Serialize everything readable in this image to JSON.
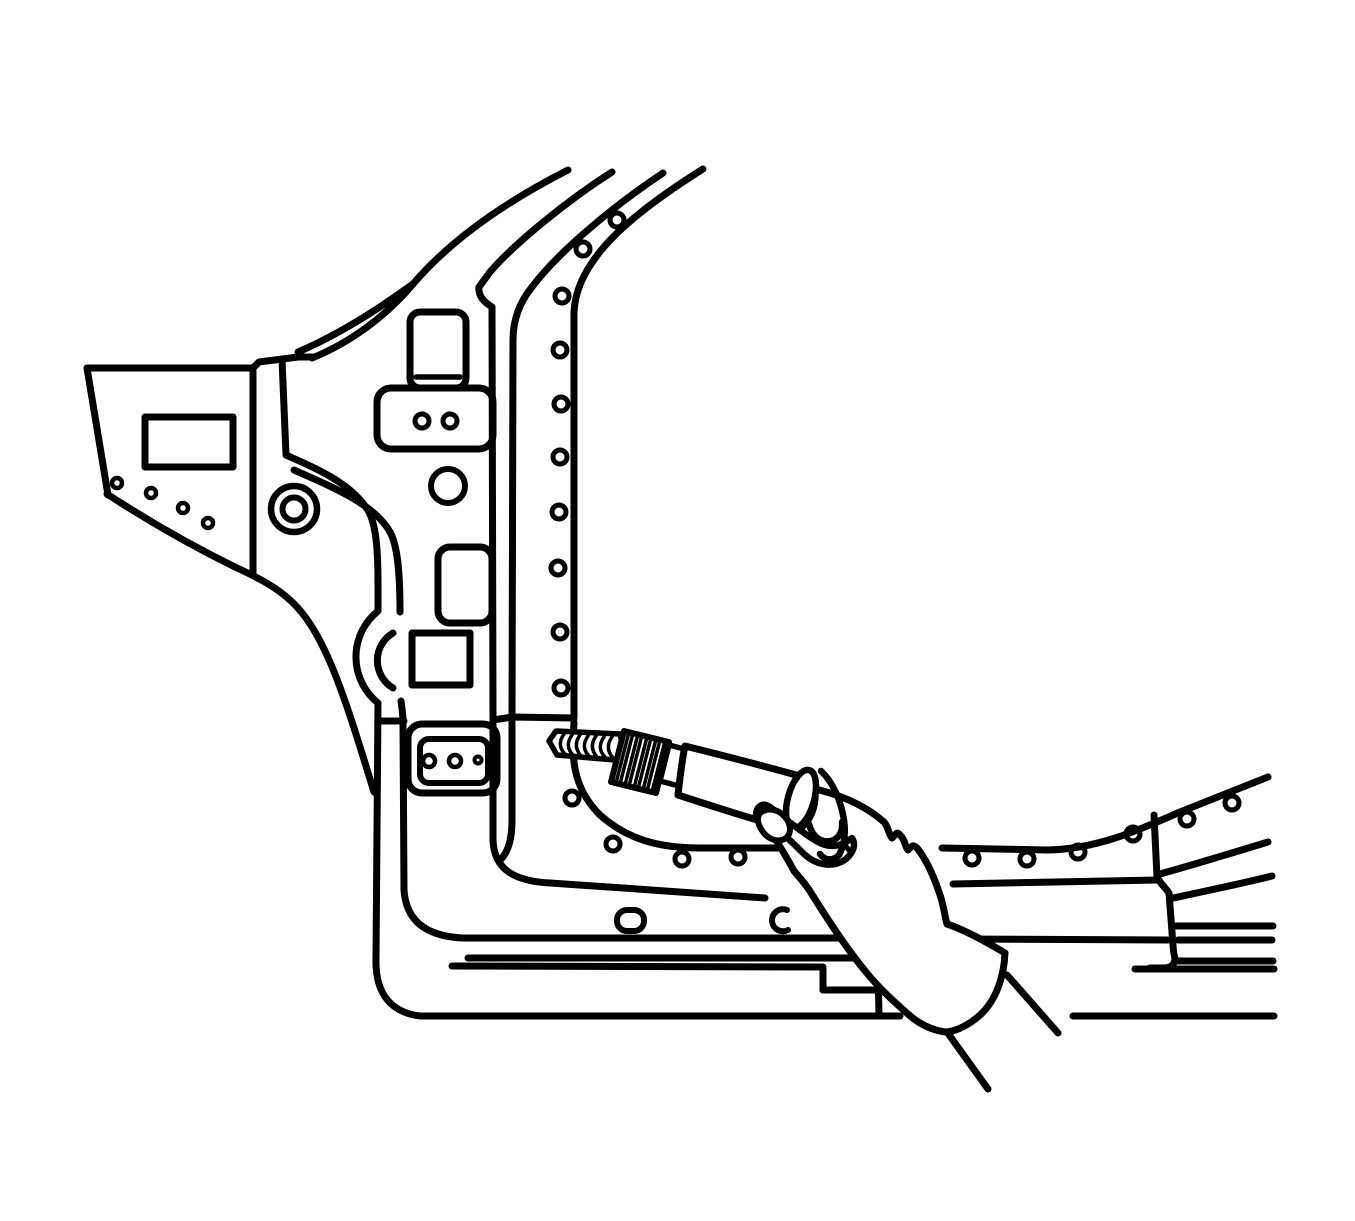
{
  "figure": {
    "kind": "technical-line-illustration",
    "subject": "drilling-spot-welds-on-body-hinge-pillar",
    "canvas": {
      "width": 1355,
      "height": 1221,
      "background": "#ffffff"
    },
    "style": {
      "stroke": "#000000",
      "stroke_width": 7,
      "fill": "none",
      "occlusion_fill": "#ffffff"
    },
    "shapes": [
      {
        "name": "fender-left-edge",
        "type": "path",
        "d": "M 87 368 L 108 495"
      },
      {
        "name": "fender-top-edge",
        "type": "path",
        "d": "M 87 368 L 253 368"
      },
      {
        "name": "cowl-top-jog",
        "type": "path",
        "d": "M 253 368 L 259 362 L 298 357 L 312 357"
      },
      {
        "name": "fender-apillar-ridge-upper",
        "type": "path",
        "d": "M 298 352 C 340 334 380 308 413 284"
      },
      {
        "name": "apillar-line-1",
        "type": "path",
        "d": "M 312 358 C 352 342 388 314 413 284 C 455 235 515 197 568 170"
      },
      {
        "name": "fender-opening-rect",
        "type": "rect",
        "x": 145,
        "y": 417,
        "wd": 88,
        "ht": 50
      },
      {
        "name": "fender-flange-hole-1",
        "type": "circle",
        "cx": 117,
        "cy": 483,
        "r": 5,
        "w": 4.5
      },
      {
        "name": "fender-flange-hole-2",
        "type": "circle",
        "cx": 151,
        "cy": 493,
        "r": 5,
        "w": 4.5
      },
      {
        "name": "fender-flange-hole-3",
        "type": "circle",
        "cx": 183,
        "cy": 508,
        "r": 5,
        "w": 4.5
      },
      {
        "name": "fender-flange-hole-4",
        "type": "circle",
        "cx": 208,
        "cy": 523,
        "r": 5,
        "w": 4.5
      },
      {
        "name": "fender-bottom-edge",
        "type": "path",
        "d": "M 107 494 C 150 522 190 545 235 567 C 285 590 305 605 330 662 C 345 697 358 740 374 792"
      },
      {
        "name": "door-gap-line",
        "type": "path",
        "d": "M 253 370 L 253 573"
      },
      {
        "name": "pillar-outer-contour",
        "type": "path",
        "d": "M 282 359 L 286 455 C 315 468 352 483 369 512 C 377 528 378 556 378 585 L 378 611 A 59 59 0 0 0 378 703 L 376 958 C 375 990 388 1012 420 1016 L 900 1016"
      },
      {
        "name": "rocker-bottom-line-right",
        "type": "path",
        "d": "M 1073 1016 L 1274 1016"
      },
      {
        "name": "pillar-inner-contour-upper",
        "type": "path",
        "d": "M 294 470 C 335 488 375 505 390 532 C 398 546 400 576 400 612"
      },
      {
        "name": "pillar-bulge-inner-arc",
        "type": "path",
        "d": "M 393 633 A 32 32 0 0 0 393 688"
      },
      {
        "name": "pillar-inner-contour-lower",
        "type": "path",
        "d": "M 401 701 C 402 708 403 715 403 722 L 404 890 C 406 920 425 936 462 938 L 843 938"
      },
      {
        "name": "rocker-mid-line-right",
        "type": "path",
        "d": "M 955 939 L 1168 940"
      },
      {
        "name": "apillar-line-2",
        "type": "path",
        "d": "M 612 172 C 568 200 515 243 490 272 L 479 287 C 478 296 484 302 492 307 L 493 718"
      },
      {
        "name": "door-front-edge-lower",
        "type": "path",
        "d": "M 493 722 L 493 840 C 494 868 512 881 550 883 C 620 888 700 893 765 898"
      },
      {
        "name": "door-bottom-line-right",
        "type": "path",
        "d": "M 953 884 L 1157 880"
      },
      {
        "name": "apillar-line-3",
        "type": "path",
        "d": "M 663 173 C 615 205 560 250 532 287 C 519 303 513 320 513 340 L 512 718"
      },
      {
        "name": "apillar-line-3-lower",
        "type": "path",
        "d": "M 512 722 L 512 820 C 512 845 505 856 499 861"
      },
      {
        "name": "apillar-line-4",
        "type": "path",
        "d": "M 703 169 C 660 196 625 222 603 248 C 583 272 575 292 574 312 L 574 718"
      },
      {
        "name": "corner-flange-arc",
        "type": "path",
        "d": "M 574 722 L 573 740 C 572 772 580 795 600 815 C 628 840 660 848 700 848 L 900 848"
      },
      {
        "name": "rocker-flange-top",
        "type": "path",
        "d": "M 942 848 L 1048 850 C 1095 849 1135 832 1180 812 L 1268 777"
      },
      {
        "name": "pillar-weld-hole-1",
        "type": "circle",
        "cx": 617,
        "cy": 220,
        "r": 7,
        "w": 5
      },
      {
        "name": "pillar-weld-hole-2",
        "type": "circle",
        "cx": 583,
        "cy": 249,
        "r": 7,
        "w": 5
      },
      {
        "name": "pillar-weld-hole-3",
        "type": "circle",
        "cx": 562,
        "cy": 296,
        "r": 7,
        "w": 5
      },
      {
        "name": "pillar-weld-hole-4",
        "type": "circle",
        "cx": 560,
        "cy": 350,
        "r": 7,
        "w": 5
      },
      {
        "name": "pillar-weld-hole-5",
        "type": "circle",
        "cx": 561,
        "cy": 404,
        "r": 7,
        "w": 5
      },
      {
        "name": "pillar-weld-hole-6",
        "type": "circle",
        "cx": 560,
        "cy": 457,
        "r": 7,
        "w": 5
      },
      {
        "name": "pillar-weld-hole-7",
        "type": "circle",
        "cx": 559,
        "cy": 512,
        "r": 7,
        "w": 5
      },
      {
        "name": "pillar-weld-hole-8",
        "type": "circle",
        "cx": 558,
        "cy": 568,
        "r": 7,
        "w": 5
      },
      {
        "name": "pillar-weld-hole-9",
        "type": "circle",
        "cx": 560,
        "cy": 632,
        "r": 7,
        "w": 5
      },
      {
        "name": "pillar-weld-hole-10",
        "type": "circle",
        "cx": 561,
        "cy": 688,
        "r": 7,
        "w": 5
      },
      {
        "name": "rocker-weld-hole-1",
        "type": "circle",
        "cx": 572,
        "cy": 798,
        "r": 7,
        "w": 5
      },
      {
        "name": "rocker-weld-hole-2",
        "type": "circle",
        "cx": 613,
        "cy": 844,
        "r": 7,
        "w": 5
      },
      {
        "name": "rocker-weld-hole-3",
        "type": "circle",
        "cx": 682,
        "cy": 859,
        "r": 7,
        "w": 5
      },
      {
        "name": "rocker-weld-hole-4",
        "type": "circle",
        "cx": 738,
        "cy": 857,
        "r": 7,
        "w": 5
      },
      {
        "name": "rocker-weld-hole-5",
        "type": "circle",
        "cx": 972,
        "cy": 858,
        "r": 7,
        "w": 5
      },
      {
        "name": "rocker-weld-hole-6",
        "type": "circle",
        "cx": 1027,
        "cy": 859,
        "r": 7,
        "w": 5
      },
      {
        "name": "rocker-weld-hole-7",
        "type": "circle",
        "cx": 1078,
        "cy": 852,
        "r": 7,
        "w": 5
      },
      {
        "name": "rocker-weld-hole-8",
        "type": "circle",
        "cx": 1133,
        "cy": 834,
        "r": 7,
        "w": 5
      },
      {
        "name": "rocker-weld-hole-9",
        "type": "circle",
        "cx": 1187,
        "cy": 819,
        "r": 7,
        "w": 5
      },
      {
        "name": "rocker-weld-hole-10",
        "type": "circle",
        "cx": 1232,
        "cy": 803,
        "r": 7,
        "w": 5
      },
      {
        "name": "shelf-line-left",
        "type": "path",
        "d": "M 380 721 L 404 721"
      },
      {
        "name": "shelf-line-right",
        "type": "path",
        "d": "M 493 720 L 513 717 L 574 718"
      },
      {
        "name": "upper-bracket",
        "type": "rect",
        "x": 410,
        "y": 312,
        "wd": 56,
        "ht": 76,
        "rx": 10
      },
      {
        "name": "upper-bracket-line",
        "type": "path",
        "d": "M 416 377 L 460 377",
        "w": 5.5
      },
      {
        "name": "hinge-plate-upper",
        "type": "rect",
        "x": 377,
        "y": 388,
        "wd": 116,
        "ht": 61,
        "rx": 14
      },
      {
        "name": "hinge-plate-upper-hole-1",
        "type": "circle",
        "cx": 422,
        "cy": 421,
        "r": 7,
        "w": 5
      },
      {
        "name": "hinge-plate-upper-hole-2",
        "type": "circle",
        "cx": 450,
        "cy": 421,
        "r": 7,
        "w": 5
      },
      {
        "name": "pillar-round-hole",
        "type": "circle",
        "cx": 448,
        "cy": 486,
        "r": 17,
        "w": 6
      },
      {
        "name": "pillar-slot-rect",
        "type": "rect",
        "x": 438,
        "y": 547,
        "wd": 54,
        "ht": 76,
        "rx": 12
      },
      {
        "name": "pillar-square-hole",
        "type": "rect",
        "x": 412,
        "y": 633,
        "wd": 58,
        "ht": 52
      },
      {
        "name": "hinge-plate-lower",
        "type": "rect",
        "x": 408,
        "y": 724,
        "wd": 89,
        "ht": 69,
        "rx": 14
      },
      {
        "name": "hinge-plate-lower-inner",
        "type": "rect",
        "x": 420,
        "y": 739,
        "wd": 68,
        "ht": 44,
        "rx": 9,
        "w": 6
      },
      {
        "name": "hinge-plate-lower-hole-1",
        "type": "circle",
        "cx": 429,
        "cy": 761,
        "r": 6,
        "w": 4.5
      },
      {
        "name": "hinge-plate-lower-hole-2",
        "type": "circle",
        "cx": 455,
        "cy": 761,
        "r": 6,
        "w": 4.5
      },
      {
        "name": "hinge-plate-lower-hole-3",
        "type": "circle",
        "cx": 478,
        "cy": 760,
        "r": 3.5,
        "w": 4
      },
      {
        "name": "grommet-outer",
        "type": "circle",
        "cx": 294,
        "cy": 509,
        "r": 23,
        "w": 6.5
      },
      {
        "name": "grommet-inner",
        "type": "circle",
        "cx": 294,
        "cy": 509,
        "r": 11.5,
        "w": 6
      },
      {
        "name": "rocker-step-line-1",
        "type": "path",
        "d": "M 468 958 L 868 958 C 875 959 878 962 878 968 L 879 1016"
      },
      {
        "name": "rocker-step-line-2",
        "type": "path",
        "d": "M 452 966 L 823 967"
      },
      {
        "name": "rocker-notch-left",
        "type": "path",
        "d": "M 823 969 L 823 990"
      },
      {
        "name": "rocker-notch-bottom",
        "type": "path",
        "d": "M 823 990 L 879 990"
      },
      {
        "name": "rocker-end-edge",
        "type": "path",
        "d": "M 1154 815 L 1157 877 C 1162 886 1166 888 1169 893 L 1172 932 C 1173 948 1174 956 1175 958 C 1175 964 1171 968 1164 968 L 1150 968"
      },
      {
        "name": "rocker-right-line-1",
        "type": "path",
        "d": "M 1176 926 L 1273 926"
      },
      {
        "name": "rocker-right-line-2",
        "type": "path",
        "d": "M 1178 940 L 1272 940"
      },
      {
        "name": "rocker-right-line-3",
        "type": "path",
        "d": "M 1178 961 L 1273 961"
      },
      {
        "name": "rocker-right-line-4",
        "type": "path",
        "d": "M 1135 969 L 1274 969"
      },
      {
        "name": "rocker-contour-curve-1",
        "type": "path",
        "d": "M 1160 874 C 1196 864 1232 853 1268 842"
      },
      {
        "name": "rocker-contour-curve-2",
        "type": "path",
        "d": "M 1173 898 C 1206 891 1240 884 1272 876"
      },
      {
        "name": "floor-oval-hole",
        "type": "rect",
        "x": 617,
        "y": 910,
        "wd": 27,
        "ht": 21,
        "rx": 10,
        "w": 6
      },
      {
        "name": "floor-c-mark",
        "type": "path",
        "d": "M 787 910 A 11 11 0 1 0 788 930",
        "w": 6
      },
      {
        "name": "hand-silhouette",
        "type": "path",
        "fill": "#ffffff",
        "d": "M 823 791 C 845 797 867 807 884 822 C 889 828 888 833 892 838 C 896 834 897 831 900 835 C 906 841 904 845 908 850 C 912 846 913 844 917 848 C 926 859 934 876 941 898 C 944 908 945 917 947 924 C 962 929 980 938 1005 953 C 1004 977 996 1001 979 1016 C 965 1028 952 1032 945 1032 C 932 1030 919 1024 908 1014 C 893 1001 878 987 866 972 C 846 948 828 920 813 896 C 806 884 799 877 794 871 C 784 852 771 832 755 806 C 762 798 780 791 800 789 C 808 788 816 789 823 791 Z"
      },
      {
        "name": "drill-bit",
        "type": "path",
        "fill": "#ffffff",
        "w": 5.5,
        "d": "M 549 741 L 556 731 L 620 734 L 626 761 L 557 755 Z"
      },
      {
        "name": "drill-bit-flute-1",
        "type": "path",
        "w": 3.5,
        "d": "M 564 734 C 559 741 559 748 565 754"
      },
      {
        "name": "drill-bit-flute-2",
        "type": "path",
        "w": 3.5,
        "d": "M 572 735 C 567 742 567 749 573 755"
      },
      {
        "name": "drill-bit-flute-3",
        "type": "path",
        "w": 3.5,
        "d": "M 580 735 C 575 742 575 749 581 756"
      },
      {
        "name": "drill-bit-flute-4",
        "type": "path",
        "w": 3.5,
        "d": "M 588 736 C 583 743 583 750 589 756"
      },
      {
        "name": "drill-bit-flute-5",
        "type": "path",
        "w": 3.5,
        "d": "M 596 736 C 591 743 591 750 597 757"
      },
      {
        "name": "drill-bit-flute-6",
        "type": "path",
        "w": 3.5,
        "d": "M 604 737 C 599 744 599 751 605 757"
      },
      {
        "name": "drill-bit-flute-7",
        "type": "path",
        "w": 3.5,
        "d": "M 612 737 C 607 744 607 751 613 758"
      },
      {
        "name": "drill-chuck",
        "type": "path",
        "fill": "#ffffff",
        "w": 6,
        "d": "M 624 731 L 669 742 L 656 793 L 611 782 Z"
      },
      {
        "name": "chuck-knurl-1",
        "type": "line",
        "x1": 629,
        "y1": 732,
        "x2": 616,
        "y2": 783,
        "w": 3.5
      },
      {
        "name": "chuck-knurl-2",
        "type": "line",
        "x1": 633,
        "y1": 733,
        "x2": 620,
        "y2": 784,
        "w": 3.5
      },
      {
        "name": "chuck-knurl-3",
        "type": "line",
        "x1": 638,
        "y1": 734,
        "x2": 625,
        "y2": 785,
        "w": 3.5
      },
      {
        "name": "chuck-knurl-4",
        "type": "line",
        "x1": 642,
        "y1": 735,
        "x2": 629,
        "y2": 786,
        "w": 3.5
      },
      {
        "name": "chuck-knurl-5",
        "type": "line",
        "x1": 647,
        "y1": 737,
        "x2": 634,
        "y2": 788,
        "w": 3.5
      },
      {
        "name": "chuck-knurl-6",
        "type": "line",
        "x1": 651,
        "y1": 738,
        "x2": 638,
        "y2": 789,
        "w": 3.5
      },
      {
        "name": "chuck-knurl-7",
        "type": "line",
        "x1": 656,
        "y1": 739,
        "x2": 643,
        "y2": 790,
        "w": 3.5
      },
      {
        "name": "chuck-knurl-8",
        "type": "line",
        "x1": 660,
        "y1": 740,
        "x2": 647,
        "y2": 791,
        "w": 3.5
      },
      {
        "name": "chuck-knurl-9",
        "type": "line",
        "x1": 665,
        "y1": 741,
        "x2": 652,
        "y2": 792,
        "w": 3.5
      },
      {
        "name": "drill-neck",
        "type": "path",
        "fill": "#ffffff",
        "w": 5.5,
        "d": "M 669 745 L 688 750 L 679 786 L 660 781 Z"
      },
      {
        "name": "drill-body",
        "type": "path",
        "fill": "#ffffff",
        "d": "M 685 746 C 725 756 765 766 803 777 C 812 780 816 789 815 799 C 814 812 808 824 797 831 C 758 821 718 808 678 795 C 680 777 682 760 685 746 Z"
      },
      {
        "name": "drill-end-cap",
        "type": "ellipse",
        "cx": 801,
        "cy": 799,
        "rx": 13,
        "ry": 30,
        "rot": 16,
        "fill": "#ffffff",
        "w": 6.5
      },
      {
        "name": "thumb",
        "type": "path",
        "fill": "#ffffff",
        "w": 6.5,
        "d": "M 756 814 C 774 824 791 841 804 854 C 817 866 834 868 846 859 C 854 852 856 844 852 838 C 842 846 830 849 818 842 C 802 833 785 818 770 807 C 763 802 757 806 756 814 Z"
      },
      {
        "name": "fingertip",
        "type": "path",
        "fill": "#ffffff",
        "w": 6,
        "d": "M 760 813 C 768 807 778 809 785 817 C 791 824 792 833 786 838 C 779 843 769 840 763 832 C 758 825 756 818 760 813 Z"
      },
      {
        "name": "finger-curl",
        "type": "path",
        "w": 6.5,
        "d": "M 809 824 C 812 836 820 843 831 841 C 839 839 843 831 842 822"
      },
      {
        "name": "finger-over-cap",
        "type": "path",
        "w": 6.5,
        "d": "M 821 771 C 833 782 841 801 844 820 C 846 834 844 846 839 855 C 833 861 825 861 820 854"
      },
      {
        "name": "knuckle-notch",
        "type": "line",
        "x1": 845,
        "y1": 845,
        "x2": 851,
        "y2": 853,
        "w": 5
      },
      {
        "name": "arm-line-1",
        "type": "line",
        "x1": 1007,
        "y1": 975,
        "x2": 1058,
        "y2": 1033
      },
      {
        "name": "arm-line-2",
        "type": "line",
        "x1": 947,
        "y1": 1032,
        "x2": 988,
        "y2": 1089
      }
    ]
  }
}
